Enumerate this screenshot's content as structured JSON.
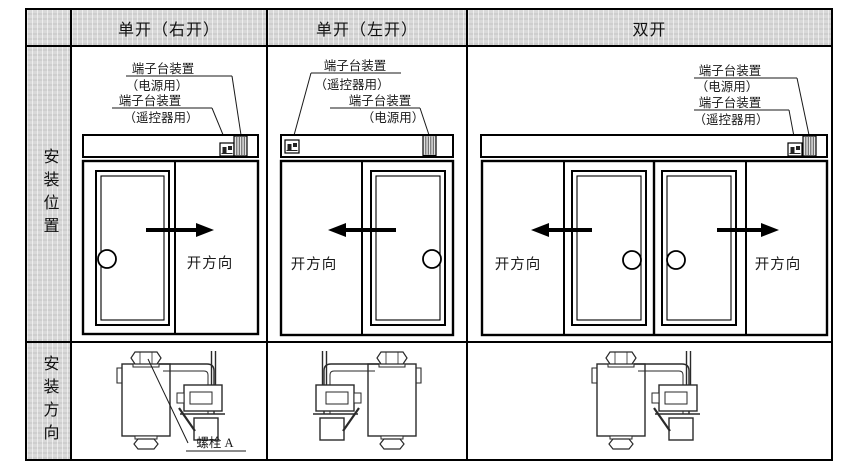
{
  "header": {
    "col1": "单开（右开）",
    "col2": "单开（左开）",
    "col3": "双开"
  },
  "row_headers": {
    "position": "安装位置",
    "direction": "安装方向"
  },
  "labels": {
    "terminal": "端子台装置",
    "power": "（电源用）",
    "remote": "（遥控器用）",
    "open_dir": "开方向",
    "bolt_a": "螺栓 A"
  },
  "colors": {
    "line": "#000000",
    "header_bg": "#d9d9d9",
    "background": "#ffffff"
  }
}
